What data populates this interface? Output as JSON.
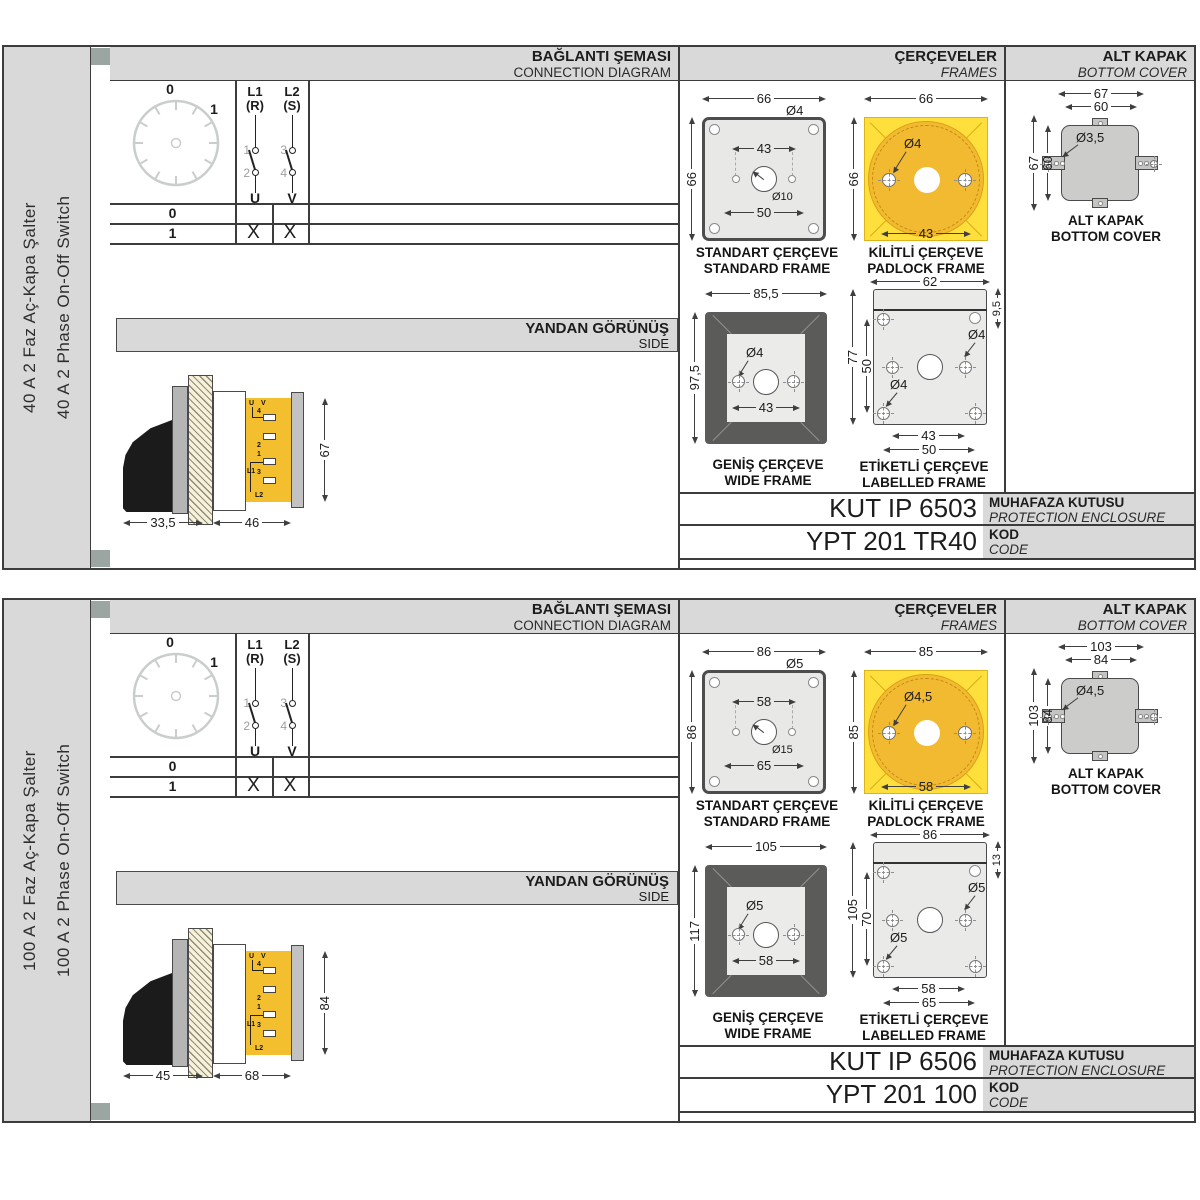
{
  "products": [
    {
      "side_label_tr": "40 A 2 Faz Aç-Kapa Şalter",
      "side_label_en": "40 A 2 Phase On-Off Switch",
      "headers": {
        "connection_tr": "BAĞLANTI ŞEMASI",
        "connection_en": "CONNECTION DIAGRAM",
        "frames_tr": "ÇERÇEVELER",
        "frames_en": "FRAMES",
        "cover_tr": "ALT KAPAK",
        "cover_en": "BOTTOM COVER",
        "side_tr": "YANDAN GÖRÜNÜŞ",
        "side_en": "SIDE"
      },
      "dial": {
        "pos0": "0",
        "pos1": "1"
      },
      "contacts": {
        "c1": {
          "line": "L1",
          "phase": "(R)",
          "top": "1",
          "bottom": "2",
          "out": "U"
        },
        "c2": {
          "line": "L2",
          "phase": "(S)",
          "top": "3",
          "bottom": "4",
          "out": "V"
        }
      },
      "switch_table": {
        "rows": [
          {
            "pos": "0",
            "u": "",
            "v": ""
          },
          {
            "pos": "1",
            "u": "X",
            "v": "X"
          }
        ]
      },
      "side_view": {
        "dim_handle": "33,5",
        "dim_body": "46",
        "dim_height": "67",
        "terminals": {
          "u": "U",
          "v": "V",
          "n4": "4",
          "n2": "2",
          "n1": "1",
          "n3": "3",
          "l1": "L1",
          "l2": "L2"
        }
      },
      "standard_frame": {
        "width": "66",
        "height": "66",
        "corner_hole": "Ø4",
        "hole_spacing": "43",
        "center_hole": "Ø10",
        "bottom_spacing": "50",
        "caption_tr": "STANDART ÇERÇEVE",
        "caption_en": "STANDARD FRAME"
      },
      "padlock_frame": {
        "width": "66",
        "height": "66",
        "hole": "Ø4",
        "hole_spacing": "43",
        "caption_tr": "KİLİTLİ ÇERÇEVE",
        "caption_en": "PADLOCK FRAME"
      },
      "wide_frame": {
        "width": "85,5",
        "height": "97,5",
        "hole": "Ø4",
        "hole_spacing": "43",
        "caption_tr": "GENİŞ ÇERÇEVE",
        "caption_en": "WIDE FRAME"
      },
      "labelled_frame": {
        "width": "62",
        "strip_height": "9,5",
        "height": "77",
        "vertical_spacing": "50",
        "hole_a": "Ø4",
        "hole_b": "Ø4",
        "hole_spacing": "43",
        "bottom_spacing": "50",
        "caption_tr": "ETİKETLİ ÇERÇEVE",
        "caption_en": "LABELLED FRAME"
      },
      "bottom_cover": {
        "outer_width": "67",
        "inner_width": "60",
        "outer_height": "67",
        "inner_height": "60",
        "hole": "Ø3,5",
        "caption_tr": "ALT KAPAK",
        "caption_en": "BOTTOM COVER"
      },
      "enclosure": {
        "value": "KUT IP 6503",
        "label_tr": "MUHAFAZA KUTUSU",
        "label_en": "PROTECTION ENCLOSURE"
      },
      "code": {
        "value": "YPT 201 TR40",
        "label_tr": "KOD",
        "label_en": "CODE"
      }
    },
    {
      "side_label_tr": "100 A 2 Faz Aç-Kapa Şalter",
      "side_label_en": "100 A 2 Phase On-Off Switch",
      "headers": {
        "connection_tr": "BAĞLANTI ŞEMASI",
        "connection_en": "CONNECTION DIAGRAM",
        "frames_tr": "ÇERÇEVELER",
        "frames_en": "FRAMES",
        "cover_tr": "ALT KAPAK",
        "cover_en": "BOTTOM COVER",
        "side_tr": "YANDAN GÖRÜNÜŞ",
        "side_en": "SIDE"
      },
      "dial": {
        "pos0": "0",
        "pos1": "1"
      },
      "contacts": {
        "c1": {
          "line": "L1",
          "phase": "(R)",
          "top": "1",
          "bottom": "2",
          "out": "U"
        },
        "c2": {
          "line": "L2",
          "phase": "(S)",
          "top": "3",
          "bottom": "4",
          "out": "V"
        }
      },
      "switch_table": {
        "rows": [
          {
            "pos": "0",
            "u": "",
            "v": ""
          },
          {
            "pos": "1",
            "u": "X",
            "v": "X"
          }
        ]
      },
      "side_view": {
        "dim_handle": "45",
        "dim_body": "68",
        "dim_height": "84",
        "terminals": {
          "u": "U",
          "v": "V",
          "n4": "4",
          "n2": "2",
          "n1": "1",
          "n3": "3",
          "l1": "L1",
          "l2": "L2"
        }
      },
      "standard_frame": {
        "width": "86",
        "height": "86",
        "corner_hole": "Ø5",
        "hole_spacing": "58",
        "center_hole": "Ø15",
        "bottom_spacing": "65",
        "caption_tr": "STANDART ÇERÇEVE",
        "caption_en": "STANDARD FRAME"
      },
      "padlock_frame": {
        "width": "85",
        "height": "85",
        "hole": "Ø4,5",
        "hole_spacing": "58",
        "caption_tr": "KİLİTLİ ÇERÇEVE",
        "caption_en": "PADLOCK FRAME"
      },
      "wide_frame": {
        "width": "105",
        "height": "117",
        "hole": "Ø5",
        "hole_spacing": "58",
        "caption_tr": "GENİŞ ÇERÇEVE",
        "caption_en": "WIDE FRAME"
      },
      "labelled_frame": {
        "width": "86",
        "strip_height": "13",
        "height": "105",
        "vertical_spacing": "70",
        "hole_a": "Ø5",
        "hole_b": "Ø5",
        "hole_spacing": "58",
        "bottom_spacing": "65",
        "caption_tr": "ETİKETLİ ÇERÇEVE",
        "caption_en": "LABELLED FRAME"
      },
      "bottom_cover": {
        "outer_width": "103",
        "inner_width": "84",
        "outer_height": "103",
        "inner_height": "84",
        "hole": "Ø4,5",
        "caption_tr": "ALT KAPAK",
        "caption_en": "BOTTOM COVER"
      },
      "enclosure": {
        "value": "KUT IP 6506",
        "label_tr": "MUHAFAZA KUTUSU",
        "label_en": "PROTECTION ENCLOSURE"
      },
      "code": {
        "value": "YPT 201 100",
        "label_tr": "KOD",
        "label_en": "CODE"
      }
    }
  ]
}
